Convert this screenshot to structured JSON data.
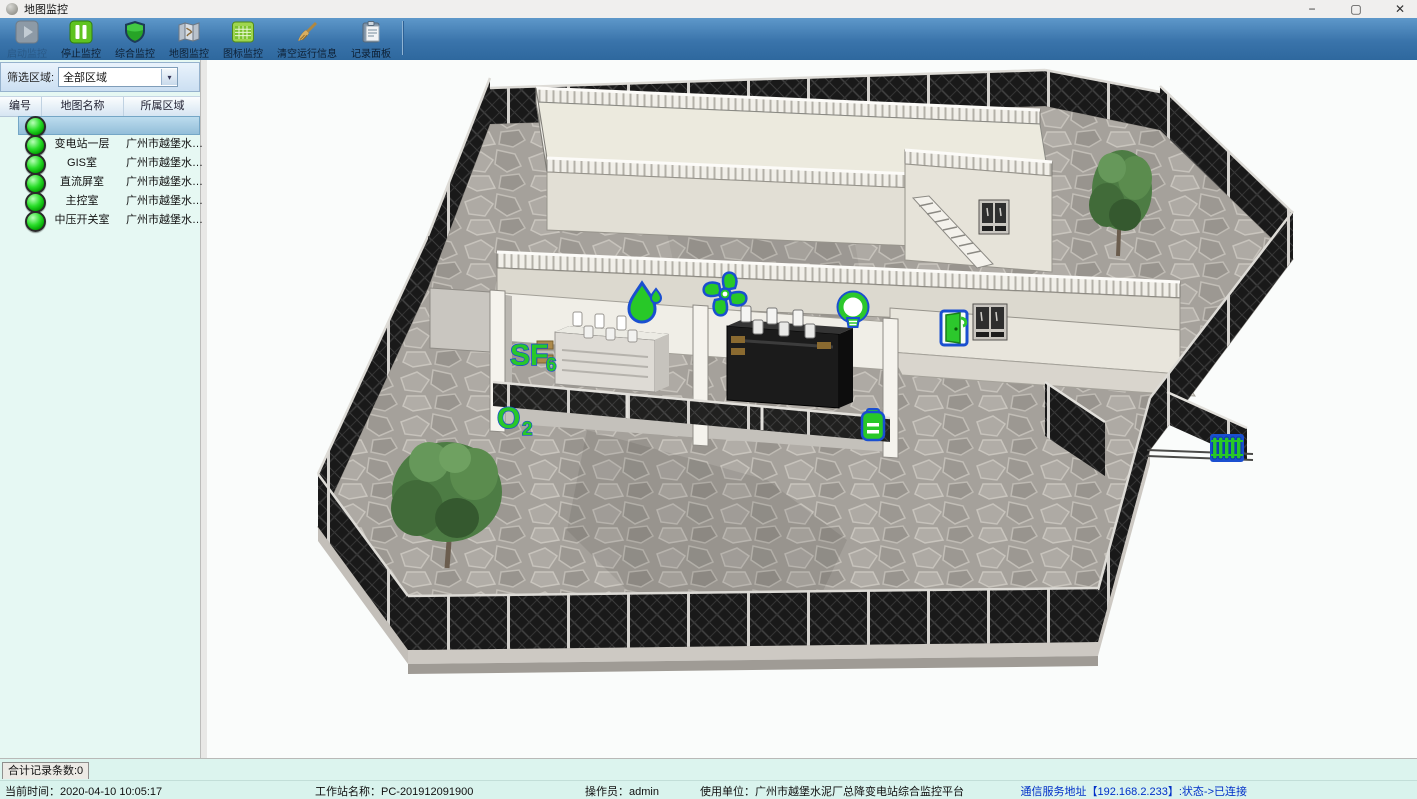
{
  "window": {
    "title": "地图监控",
    "minimize_glyph": "−",
    "maximize_glyph": "▢",
    "close_glyph": "✕"
  },
  "toolbar": {
    "buttons": [
      {
        "label": "启动监控",
        "disabled": true,
        "icon": "play-icon"
      },
      {
        "label": "停止监控",
        "disabled": false,
        "icon": "pause-icon"
      },
      {
        "label": "综合监控",
        "disabled": false,
        "icon": "shield-icon"
      },
      {
        "label": "地图监控",
        "disabled": false,
        "icon": "map-icon"
      },
      {
        "label": "图标监控",
        "disabled": false,
        "icon": "grid-icon"
      },
      {
        "label": "清空运行信息",
        "disabled": false,
        "icon": "broom-icon"
      },
      {
        "label": "记录面板",
        "disabled": false,
        "icon": "clipboard-icon"
      }
    ]
  },
  "sidebar": {
    "filter_label": "筛选区域:",
    "filter_value": "全部区域",
    "filter_arrow": "▾",
    "table": {
      "headers": [
        "编号",
        "地图名称",
        "所属区域"
      ],
      "rows": [
        {
          "name": "",
          "region": "",
          "status": "online",
          "selected": true
        },
        {
          "name": "变电站一层",
          "region": "广州市越堡水…",
          "status": "online",
          "selected": false
        },
        {
          "name": "GIS室",
          "region": "广州市越堡水…",
          "status": "online",
          "selected": false
        },
        {
          "name": "直流屏室",
          "region": "广州市越堡水…",
          "status": "online",
          "selected": false
        },
        {
          "name": "主控室",
          "region": "广州市越堡水…",
          "status": "online",
          "selected": false
        },
        {
          "name": "中压开关室",
          "region": "广州市越堡水…",
          "status": "online",
          "selected": false
        }
      ]
    }
  },
  "map": {
    "labels": {
      "sf6_main": "SF",
      "sf6_sub": "6",
      "o2_main": "O",
      "o2_sub": "2"
    },
    "icons": [
      "water-drop-sensor",
      "fan-sensor",
      "light-sensor",
      "sf6-sensor",
      "o2-sensor",
      "battery-sensor",
      "door-sensor",
      "radiator-sensor"
    ],
    "accent_green": "#28c828",
    "accent_blue": "#1a4fd0"
  },
  "record_panel": {
    "tab_label": "合计记录条数:0"
  },
  "statusbar": {
    "current_time": "当前时间：2020-04-10 10:05:17",
    "workstation": "工作站名称：PC-201912091900",
    "operator": "操作员：admin",
    "organization": "使用单位：广州市越堡水泥厂总降变电站综合监控平台",
    "connection": "通信服务地址【192.168.2.233】:状态->已连接"
  }
}
